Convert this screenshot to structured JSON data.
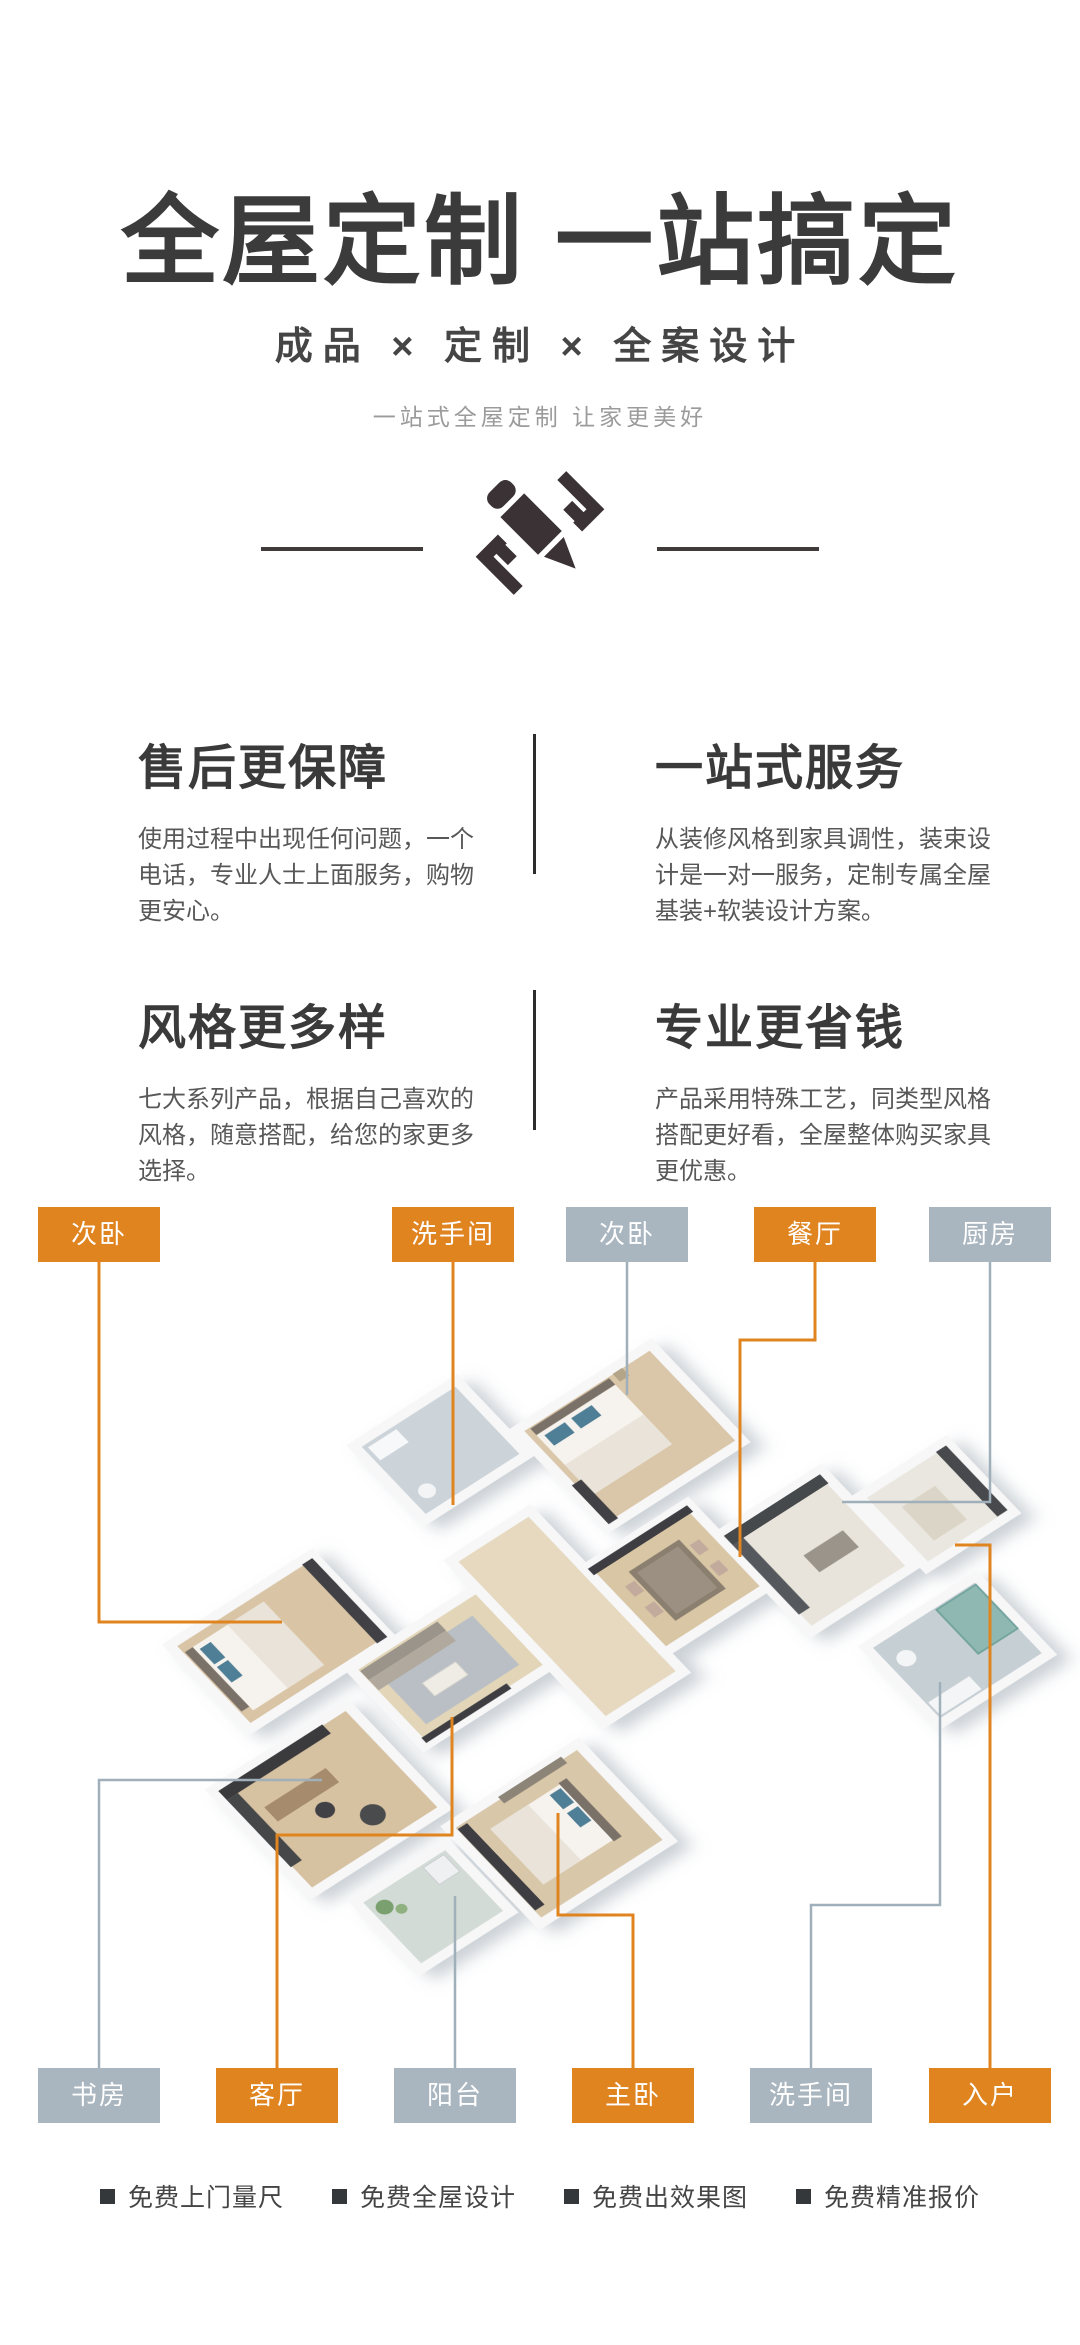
{
  "hero": {
    "title": "全屋定制 一站搞定",
    "subtitle": "成品 × 定制 × 全案设计",
    "tagline": "一站式全屋定制 让家更美好",
    "icon": "pencil-ruler-icon"
  },
  "features": [
    {
      "title": "售后更保障",
      "body": "使用过程中出现任何问题，一个电话，专业人士上面服务，购物更安心。"
    },
    {
      "title": "一站式服务",
      "body": "从装修风格到家具调性，装束设计是一对一服务，定制专属全屋基装+软装设计方案。"
    },
    {
      "title": "风格更多样",
      "body": "七大系列产品，根据自己喜欢的风格，随意搭配，给您的家更多选择。"
    },
    {
      "title": "专业更省钱",
      "body": "产品采用特殊工艺，同类型风格搭配更好看，全屋整体购买家具更优惠。"
    }
  ],
  "floorplan": {
    "colors": {
      "orange": "#e08420",
      "gray": "#a9b5bf",
      "line_orange": "#e08420",
      "line_gray": "#9fb0ba"
    },
    "top_labels": [
      {
        "text": "次卧",
        "variant": "orange"
      },
      {
        "text": "洗手间",
        "variant": "orange"
      },
      {
        "text": "次卧",
        "variant": "gray"
      },
      {
        "text": "餐厅",
        "variant": "orange"
      },
      {
        "text": "厨房",
        "variant": "gray"
      }
    ],
    "bottom_labels": [
      {
        "text": "书房",
        "variant": "gray"
      },
      {
        "text": "客厅",
        "variant": "orange"
      },
      {
        "text": "阳台",
        "variant": "gray"
      },
      {
        "text": "主卧",
        "variant": "orange"
      },
      {
        "text": "洗手间",
        "variant": "gray"
      },
      {
        "text": "入户",
        "variant": "orange"
      }
    ]
  },
  "services": [
    {
      "label": "免费上门量尺"
    },
    {
      "label": "免费全屋设计"
    },
    {
      "label": "免费出效果图"
    },
    {
      "label": "免费精准报价"
    }
  ]
}
